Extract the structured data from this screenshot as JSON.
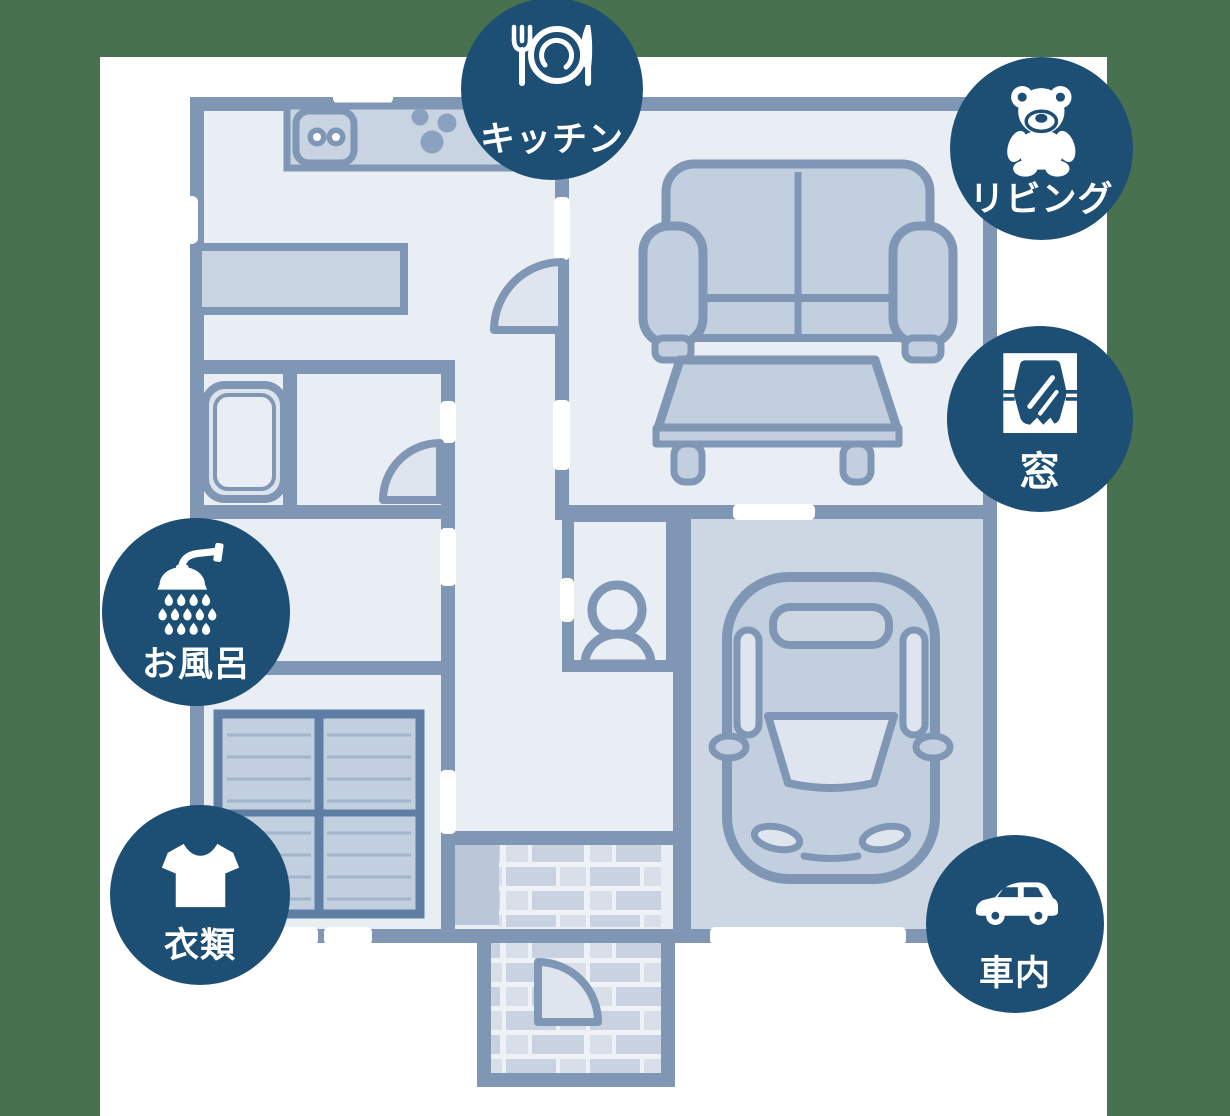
{
  "palette": {
    "bg": "#47714f",
    "canvas": "#ffffff",
    "badge": "#1d4e74",
    "badge_text": "#ffffff",
    "wall": "#7f97b5",
    "room": "#e9edf4",
    "room_dark": "#cdd7e4",
    "furn": "#c2cfdf",
    "furn_light": "#dfe5ee",
    "counter": "#c9d4e2",
    "stripe": "#a3b5cb",
    "closet_border": "#5f7ea4",
    "brick_a": "#c8d2e0",
    "brick_b": "#d8dfe9",
    "mortar": "#eef1f6",
    "step": "#bac7d9",
    "dots": "#8aa2c0"
  },
  "badges": [
    {
      "id": "kitchen",
      "label": "キッチン",
      "icon": "fork-plate-knife-icon"
    },
    {
      "id": "living",
      "label": "リビング",
      "icon": "teddy-bear-icon"
    },
    {
      "id": "window",
      "label": "窓",
      "icon": "window-curtains-icon"
    },
    {
      "id": "bath",
      "label": "お風呂",
      "icon": "shower-head-icon"
    },
    {
      "id": "clothes",
      "label": "衣類",
      "icon": "t-shirt-icon"
    },
    {
      "id": "car-interior",
      "label": "車内",
      "icon": "car-side-icon"
    }
  ],
  "floorplan": {
    "elements": [
      "kitchen-counter",
      "sink",
      "stove-burners",
      "shelf",
      "bathtub",
      "toilet-figure",
      "sofa",
      "low-table",
      "striped-closet",
      "car-top-view",
      "entrance-step",
      "brick-entrance",
      "brick-porch",
      "door-arcs",
      "wall-windows"
    ]
  }
}
